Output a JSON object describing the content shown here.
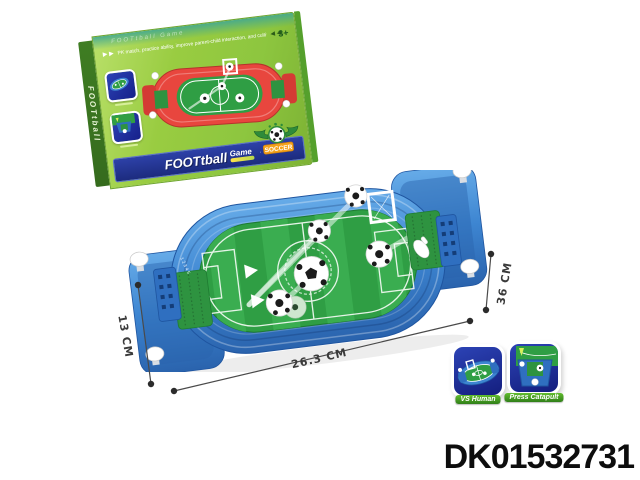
{
  "page": {
    "background": "#ffffff"
  },
  "box": {
    "side_text": "FOOTtball",
    "top_watermark": "FOOTtball Game",
    "arrows_left": "▶ ▶",
    "arrows_right": "◀ ◀",
    "tagline": "PK match, practice ability, improve parent-child interaction, and cultivate coordination",
    "age_label": "3+",
    "title_main": "FOOTtball",
    "title_sub": "Game",
    "band_dots": "· · · —",
    "badge_text": "SOCCER",
    "colors": {
      "box_green": "#8dc63f",
      "band_blue": "#26379f",
      "art_red": "#e8463e"
    }
  },
  "product": {
    "score_numbers": "1 2 3 4 5",
    "colors": {
      "body_blue": "#3d85d1",
      "body_blue_dark": "#2a63ad",
      "field_green": "#2f9e44",
      "field_stripe": "#3cb152",
      "goal_bed_green": "#2e9340",
      "ball_white": "#ffffff"
    }
  },
  "dimensions": {
    "height_label": "13 CM",
    "length_label": "26.3 CM",
    "depth_label": "36 CM",
    "line_color": "#4a4a4a"
  },
  "insets": {
    "items": [
      {
        "label": "VS Human"
      },
      {
        "label": "Press Catapult"
      }
    ]
  },
  "product_code": {
    "text": "DK01532731",
    "color": "#0d0d0d"
  }
}
